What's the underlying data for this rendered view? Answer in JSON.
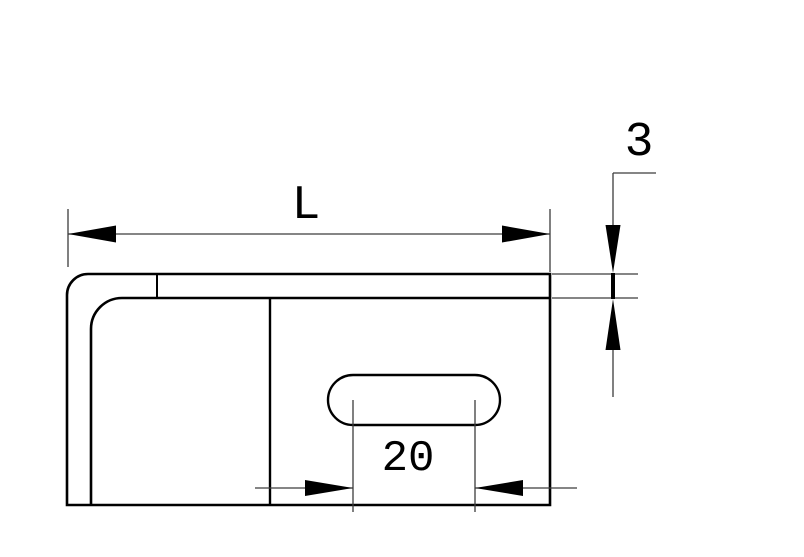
{
  "drawing": {
    "background": "#ffffff",
    "line_color": "#000000",
    "thin_line_color": "#3c3c3c",
    "labels": {
      "length": "L",
      "thickness": "3",
      "slot_width": "20"
    }
  }
}
